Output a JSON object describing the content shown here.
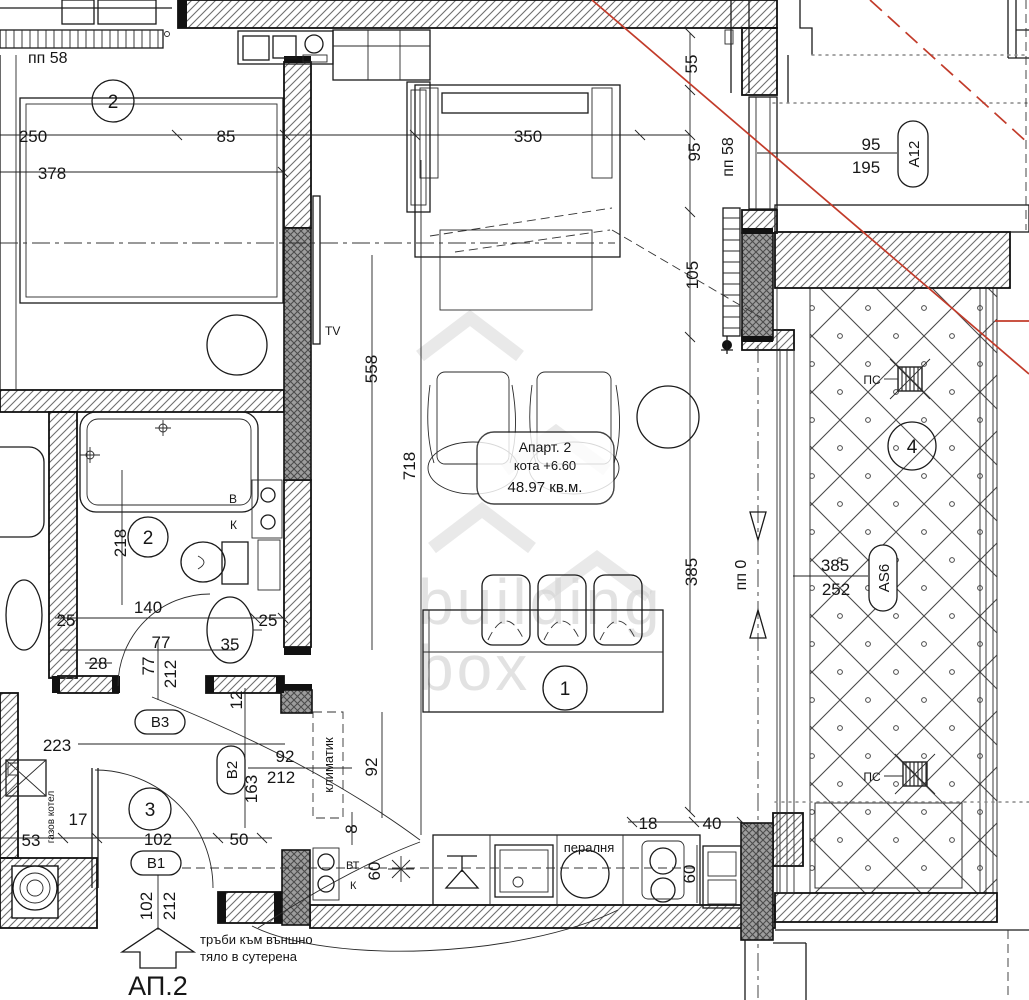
{
  "apartment": {
    "name": "Апарт. 2",
    "elevation": "кота +6.60",
    "area": "48.97 кв.м.",
    "entrance": "АП.2"
  },
  "rooms": {
    "living": "1",
    "bedroom": "2",
    "bathroom": "2",
    "hall": "3",
    "terrace": "4"
  },
  "tags": {
    "a12": "A12",
    "as6": "AS6",
    "b1": "B1",
    "b2": "B2",
    "b3": "B3"
  },
  "levels": {
    "pp58_top": "пп 58",
    "pp58_right": "пп 58",
    "pp0": "пп 0"
  },
  "labels": {
    "tv": "TV",
    "water": "В",
    "sewer": "К",
    "wt": "ВТ",
    "k": "К",
    "ac": "климатик",
    "washer": "пералня",
    "boiler": "газов котел",
    "drain_top": "ПС",
    "drain_bottom": "ПС",
    "note1": "тръби към външно",
    "note2": "тяло в сутерена"
  },
  "dims": {
    "w250": "250",
    "w85": "85",
    "w378": "378",
    "w350": "350",
    "h55": "55",
    "h95": "95",
    "w95": "95",
    "w195": "195",
    "h105": "105",
    "h558": "558",
    "h718": "718",
    "h385": "385",
    "w385": "385",
    "w252": "252",
    "h218": "218",
    "w140": "140",
    "w77": "77",
    "w28": "28",
    "w25l": "25",
    "w25r": "25",
    "w35": "35",
    "v77": "77",
    "v212": "212",
    "v12": "12",
    "w223": "223",
    "w92": "92",
    "w212": "212",
    "v163": "163",
    "v92": "92",
    "w102": "102",
    "w50": "50",
    "w17": "17",
    "w53": "53",
    "w18": "18",
    "w40": "40",
    "v8": "8",
    "v60a": "60",
    "v60b": "60",
    "v102": "102",
    "v212b": "212"
  },
  "watermark": {
    "line1": "building",
    "line2": "box"
  },
  "colors": {
    "line": "#1a1a1a",
    "red": "#c23b2a",
    "hatch": "#6f6f6f",
    "dark_wall": "#9d9d9d",
    "watermark": "#d6d6d6"
  }
}
